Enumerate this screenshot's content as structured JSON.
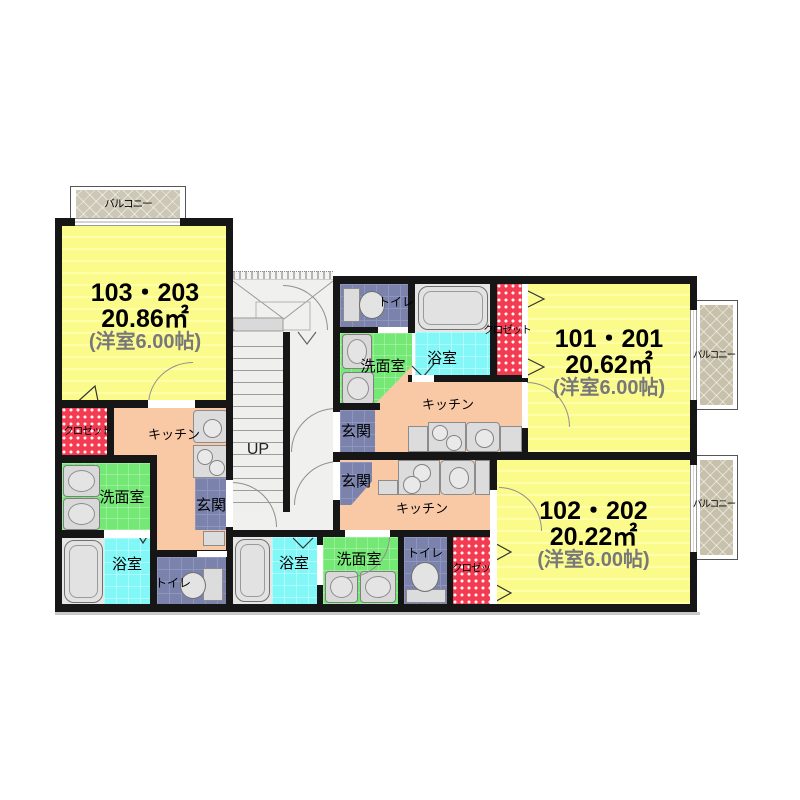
{
  "units": {
    "u103": {
      "name": "103・203",
      "area": "20.86㎡",
      "type": "(洋室6.00帖)"
    },
    "u101": {
      "name": "101・201",
      "area": "20.62㎡",
      "type": "(洋室6.00帖)"
    },
    "u102": {
      "name": "102・202",
      "area": "20.22㎡",
      "type": "(洋室6.00帖)"
    }
  },
  "labels": {
    "balcony": "バルコニー",
    "kitchen": "キッチン",
    "entrance": "玄関",
    "washroom": "洗面室",
    "bathroom": "浴室",
    "toilet": "トイレ",
    "closet": "クロゼット",
    "closet_truncated": "クロゼッ",
    "stairs_up": "UP"
  },
  "colors": {
    "room_yellow": "#FBFB8C",
    "kitchen_salmon": "#F9C9A6",
    "washroom_green": "#74E874",
    "bathroom_cyan": "#82F7F7",
    "entrance_slate": "#7B83AD",
    "closet_red": "#F33B52",
    "balcony_tan": "#C7C0AA",
    "wall_black": "#161616",
    "fixture_gray": "#DCDCDC"
  }
}
